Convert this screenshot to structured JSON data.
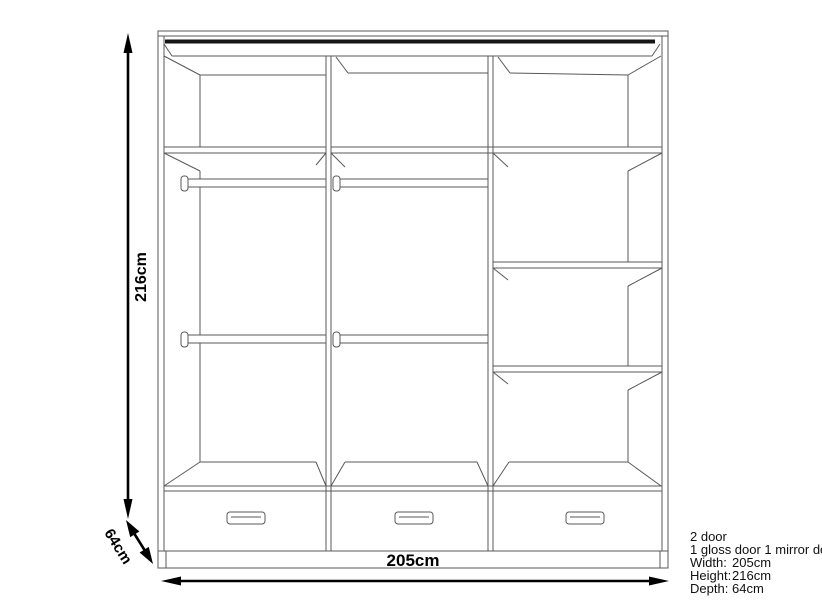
{
  "dimensions": {
    "height": "216cm",
    "width": "205cm",
    "depth": "64cm"
  },
  "spec": {
    "line1": "2 door",
    "line2": "1 gloss door 1 mirror do",
    "rows": [
      {
        "label": "Width:",
        "value": "205cm"
      },
      {
        "label": "Height:",
        "value": "216cm"
      },
      {
        "label": "Depth:",
        "value": "64cm"
      }
    ]
  },
  "colors": {
    "outline": "#585858",
    "door_track": "#161616",
    "dimension": "#000000",
    "background": "#ffffff"
  }
}
